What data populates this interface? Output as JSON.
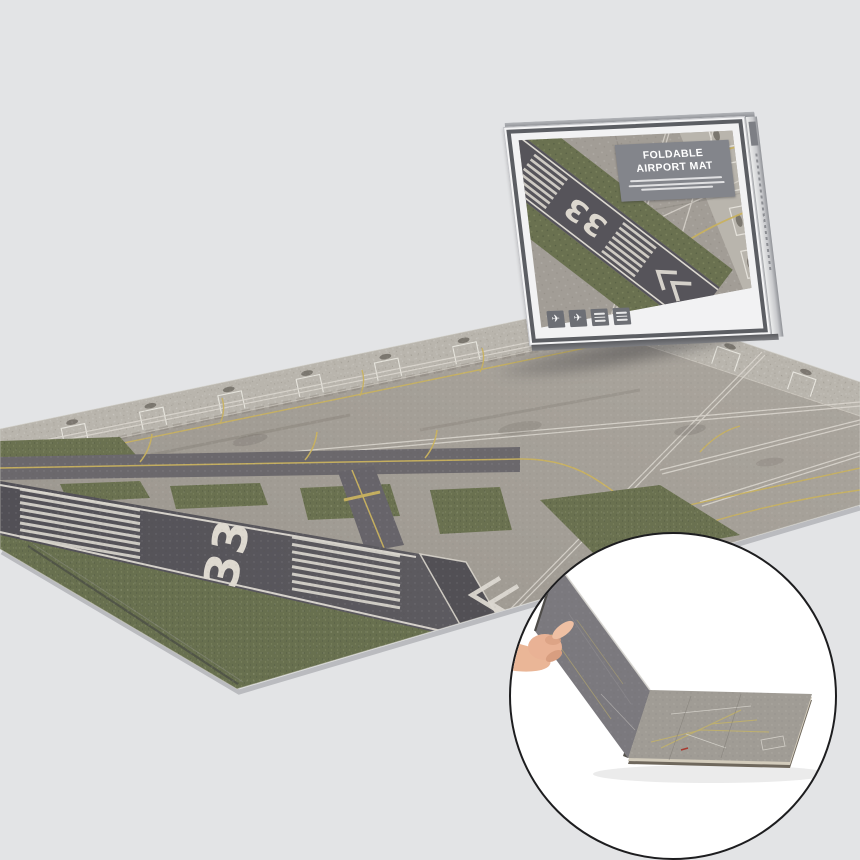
{
  "page": {
    "background_color": "#e3e4e6"
  },
  "mat": {
    "runway_number": "33",
    "colors": {
      "apron": "#a19c95",
      "apron_far_band": "#b9b5ad",
      "runway": "#56545a",
      "grass": "#6a7150",
      "taxiline_yellow": "#c9b25f",
      "marking_white": "#ddd9d1"
    }
  },
  "product_box": {
    "title_line1": "FOLDABLE",
    "title_line2": "AIRPORT MAT",
    "runway_number": "33",
    "airplane_glyph": "✈",
    "badges": [
      {
        "icon": "airplane-icon"
      },
      {
        "icon": "airplane-icon"
      },
      {
        "icon": "spec-text-badge"
      },
      {
        "icon": "spec-text-badge"
      }
    ],
    "label_background": "#83858b"
  },
  "inset": {
    "border_color": "#1d1d1f",
    "background": "#ffffff"
  }
}
